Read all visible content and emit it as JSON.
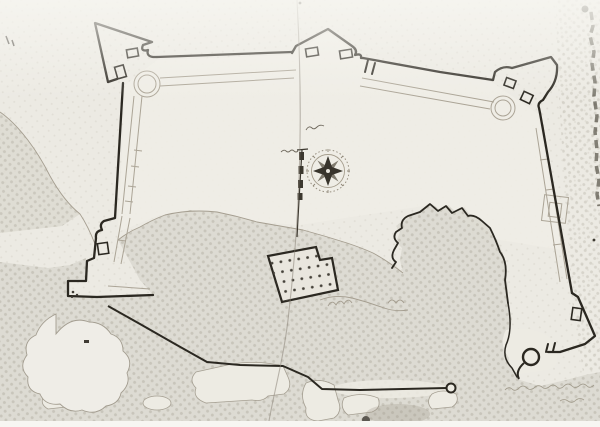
{
  "document": {
    "kind": "scanned photograph of a hand-drawn fortress plan",
    "description": "Ink plan of a bastioned coastal fort with pointed corner bastions, round towers, a compass rose, a vertical scale bar, a dotted barracks building, shaded halftone terrain and a road ending at a well",
    "paper_color": "#eceae3",
    "ink_color": "#2b2821",
    "faint_line_color": "#a8a195",
    "halftone_color": "#b7b3a7"
  },
  "map": {
    "compass_rose": {
      "type": "8-point star rose",
      "center_x": 328,
      "center_y": 171,
      "outer_radius": 21
    },
    "scale_bar": {
      "orientation": "vertical",
      "segments": 4,
      "x": 301,
      "top_y": 150,
      "bottom_y": 237
    },
    "features": [
      {
        "name": "north-west-bastion",
        "shape": "pennant-shaped bastion with faint round tower"
      },
      {
        "name": "north-bastion",
        "shape": "triangular mid-curtain bastion"
      },
      {
        "name": "north-east-bastion",
        "shape": "arrow-shaped bastion with faint round tower"
      },
      {
        "name": "south-east-bastion",
        "shape": "demi-bastion with bold round tower"
      },
      {
        "name": "south-west-corner",
        "shape": "stepped wall angle"
      },
      {
        "name": "barracks-building",
        "shape": "tilted rectangle filled with a grid of dots"
      },
      {
        "name": "aqueduct-road",
        "shape": "bold polyline ending in a small circular well"
      },
      {
        "name": "rock-outcrop",
        "shape": "scribbled white blob in shaded ground, lower left"
      },
      {
        "name": "terrain-shading",
        "shape": "halftone dotted ground across lower half and page edges"
      },
      {
        "name": "fold-crease",
        "shape": "vertical fold line left of page centre"
      },
      {
        "name": "page-edge-shadow",
        "shape": "dark broken streak along right edge"
      }
    ],
    "annotations": [
      {
        "name": "courtyard-label",
        "legibility": "illegible tiny handwriting above compass rose"
      },
      {
        "name": "scale-label",
        "legibility": "illegible tiny handwriting beside scale bar"
      },
      {
        "name": "bottom-right-inscription",
        "legibility": "very faint illegible handwriting row"
      }
    ]
  }
}
